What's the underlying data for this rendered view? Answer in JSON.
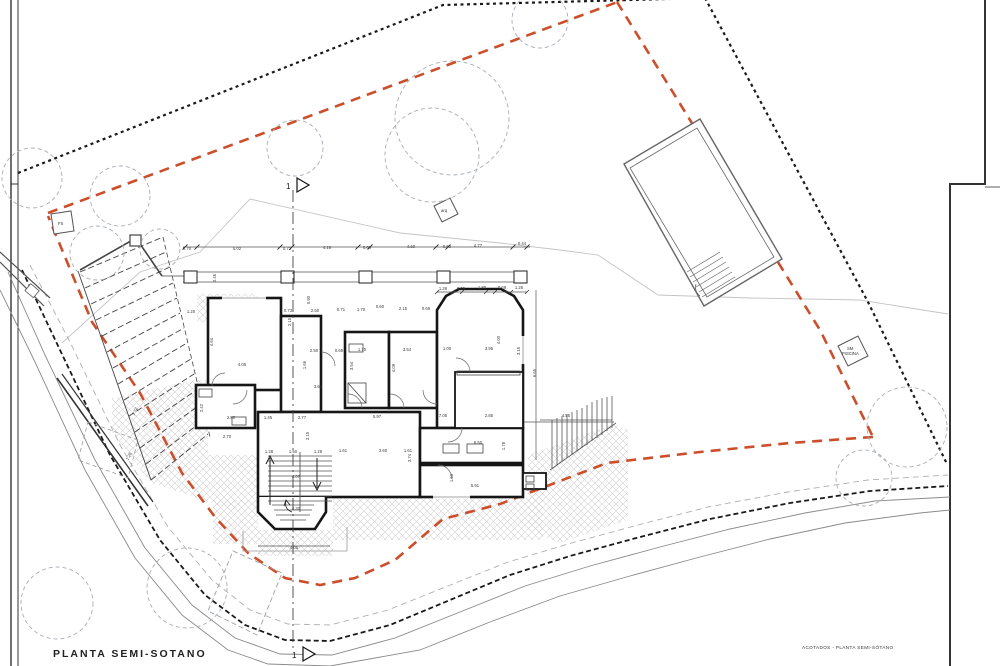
{
  "titles": {
    "bottom_left": "PLANTA  SEMI-SOTANO",
    "bottom_right": "ACOTADOS - PLANTA SEMI-SÓTANO"
  },
  "markers": {
    "section_number_top": "1",
    "section_number_bottom": "1",
    "fs_label": "FS",
    "arq_label": "arq",
    "pool_label_line1": "SM",
    "pool_label_line2": "PISCINA"
  },
  "colors": {
    "setback_line": "#cc4e2a",
    "boundary_line": "#1a1a1a",
    "wall": "#161616",
    "tree": "#a8aeb4",
    "hatch": "#d2d2d2",
    "contour": "#c4c4c4",
    "road": "#8a8a8a",
    "dim_text": "#3a3a3a",
    "paper": "#ffffff"
  },
  "trees": [
    {
      "cx": 32,
      "cy": 178,
      "r": 30
    },
    {
      "cx": 120,
      "cy": 196,
      "r": 30
    },
    {
      "cx": 97,
      "cy": 253,
      "r": 27
    },
    {
      "cx": 160,
      "cy": 249,
      "r": 20
    },
    {
      "cx": 295,
      "cy": 148,
      "r": 28
    },
    {
      "cx": 452,
      "cy": 118,
      "r": 57
    },
    {
      "cx": 432,
      "cy": 155,
      "r": 47
    },
    {
      "cx": 540,
      "cy": 20,
      "r": 28
    },
    {
      "cx": 907,
      "cy": 427,
      "r": 40
    },
    {
      "cx": 864,
      "cy": 478,
      "r": 28
    },
    {
      "cx": 187,
      "cy": 588,
      "r": 40
    },
    {
      "cx": 57,
      "cy": 603,
      "r": 36
    }
  ],
  "dimension_labels": [
    {
      "t": "0.70",
      "x": 187,
      "y": 250
    },
    {
      "t": "5.02",
      "x": 237,
      "y": 250
    },
    {
      "t": "0.72",
      "x": 287,
      "y": 250
    },
    {
      "t": "4.18",
      "x": 327,
      "y": 249
    },
    {
      "t": "0.60",
      "x": 367,
      "y": 249
    },
    {
      "t": "4.60",
      "x": 411,
      "y": 248
    },
    {
      "t": "0.60",
      "x": 447,
      "y": 248
    },
    {
      "t": "4.77",
      "x": 478,
      "y": 247
    },
    {
      "t": "0.44",
      "x": 522,
      "y": 245
    },
    {
      "t": "1.26",
      "x": 443,
      "y": 290
    },
    {
      "t": "0.69",
      "x": 461,
      "y": 290
    },
    {
      "t": "1.80",
      "x": 482,
      "y": 289
    },
    {
      "t": "0.69",
      "x": 502,
      "y": 289
    },
    {
      "t": "1.26",
      "x": 519,
      "y": 289
    },
    {
      "t": "0.73",
      "x": 288,
      "y": 312
    },
    {
      "t": "2.50",
      "x": 315,
      "y": 312
    },
    {
      "t": "0.71",
      "x": 341,
      "y": 311
    },
    {
      "t": "1.70",
      "x": 361,
      "y": 311
    },
    {
      "t": "0.60",
      "x": 380,
      "y": 308
    },
    {
      "t": "2.15",
      "x": 403,
      "y": 310
    },
    {
      "t": "0.69",
      "x": 426,
      "y": 310
    },
    {
      "t": "2.50",
      "x": 314,
      "y": 352
    },
    {
      "t": "0.69",
      "x": 339,
      "y": 352
    },
    {
      "t": "1.70",
      "x": 362,
      "y": 351
    },
    {
      "t": "3.54",
      "x": 407,
      "y": 351
    },
    {
      "t": "1.00",
      "x": 447,
      "y": 350
    },
    {
      "t": "3.95",
      "x": 489,
      "y": 350
    },
    {
      "t": "1.20",
      "x": 191,
      "y": 313
    },
    {
      "t": "4.64",
      "x": 213,
      "y": 342,
      "r": -90
    },
    {
      "t": "4.06",
      "x": 242,
      "y": 366
    },
    {
      "t": "2.42",
      "x": 203,
      "y": 408,
      "r": -90
    },
    {
      "t": "2.80",
      "x": 231,
      "y": 419
    },
    {
      "t": "1.45",
      "x": 268,
      "y": 419
    },
    {
      "t": "2.77",
      "x": 302,
      "y": 419
    },
    {
      "t": "5.97",
      "x": 377,
      "y": 418
    },
    {
      "t": "7.05",
      "x": 443,
      "y": 417
    },
    {
      "t": "2.85",
      "x": 489,
      "y": 417
    },
    {
      "t": "4.55",
      "x": 566,
      "y": 417
    },
    {
      "t": "2.70",
      "x": 227,
      "y": 438
    },
    {
      "t": "0.90",
      "x": 310,
      "y": 300,
      "r": -90
    },
    {
      "t": "2.15",
      "x": 291,
      "y": 322,
      "r": -90
    },
    {
      "t": "1.66",
      "x": 306,
      "y": 365,
      "r": -90
    },
    {
      "t": "3.54",
      "x": 353,
      "y": 366,
      "r": -90
    },
    {
      "t": "4.09",
      "x": 395,
      "y": 368,
      "r": -90
    },
    {
      "t": "3.61",
      "x": 318,
      "y": 388
    },
    {
      "t": "4.00",
      "x": 500,
      "y": 340,
      "r": -90
    },
    {
      "t": "3.15",
      "x": 520,
      "y": 351,
      "r": -90
    },
    {
      "t": "6.65",
      "x": 536,
      "y": 373,
      "r": -90
    },
    {
      "t": "3.15",
      "x": 309,
      "y": 436,
      "r": -90
    },
    {
      "t": "3.74",
      "x": 411,
      "y": 458,
      "r": -90
    },
    {
      "t": "1.28",
      "x": 269,
      "y": 453
    },
    {
      "t": "1.50",
      "x": 293,
      "y": 453
    },
    {
      "t": "1.28",
      "x": 318,
      "y": 453
    },
    {
      "t": "1.61",
      "x": 343,
      "y": 452
    },
    {
      "t": "3.60",
      "x": 383,
      "y": 452
    },
    {
      "t": "1.61",
      "x": 408,
      "y": 452
    },
    {
      "t": "4.07",
      "x": 296,
      "y": 478
    },
    {
      "t": "6.50",
      "x": 478,
      "y": 444
    },
    {
      "t": "1.78",
      "x": 505,
      "y": 446,
      "r": -90
    },
    {
      "t": "1.60",
      "x": 453,
      "y": 478,
      "r": -90
    },
    {
      "t": "5.91",
      "x": 475,
      "y": 487
    },
    {
      "t": "4.30",
      "x": 296,
      "y": 510
    },
    {
      "t": "4.05",
      "x": 294,
      "y": 549
    },
    {
      "t": "1.72",
      "x": 136,
      "y": 412,
      "r": -62
    },
    {
      "t": "1.26",
      "x": 130,
      "y": 457,
      "r": -62
    },
    {
      "t": "0.46",
      "x": 216,
      "y": 278,
      "r": -90
    }
  ]
}
